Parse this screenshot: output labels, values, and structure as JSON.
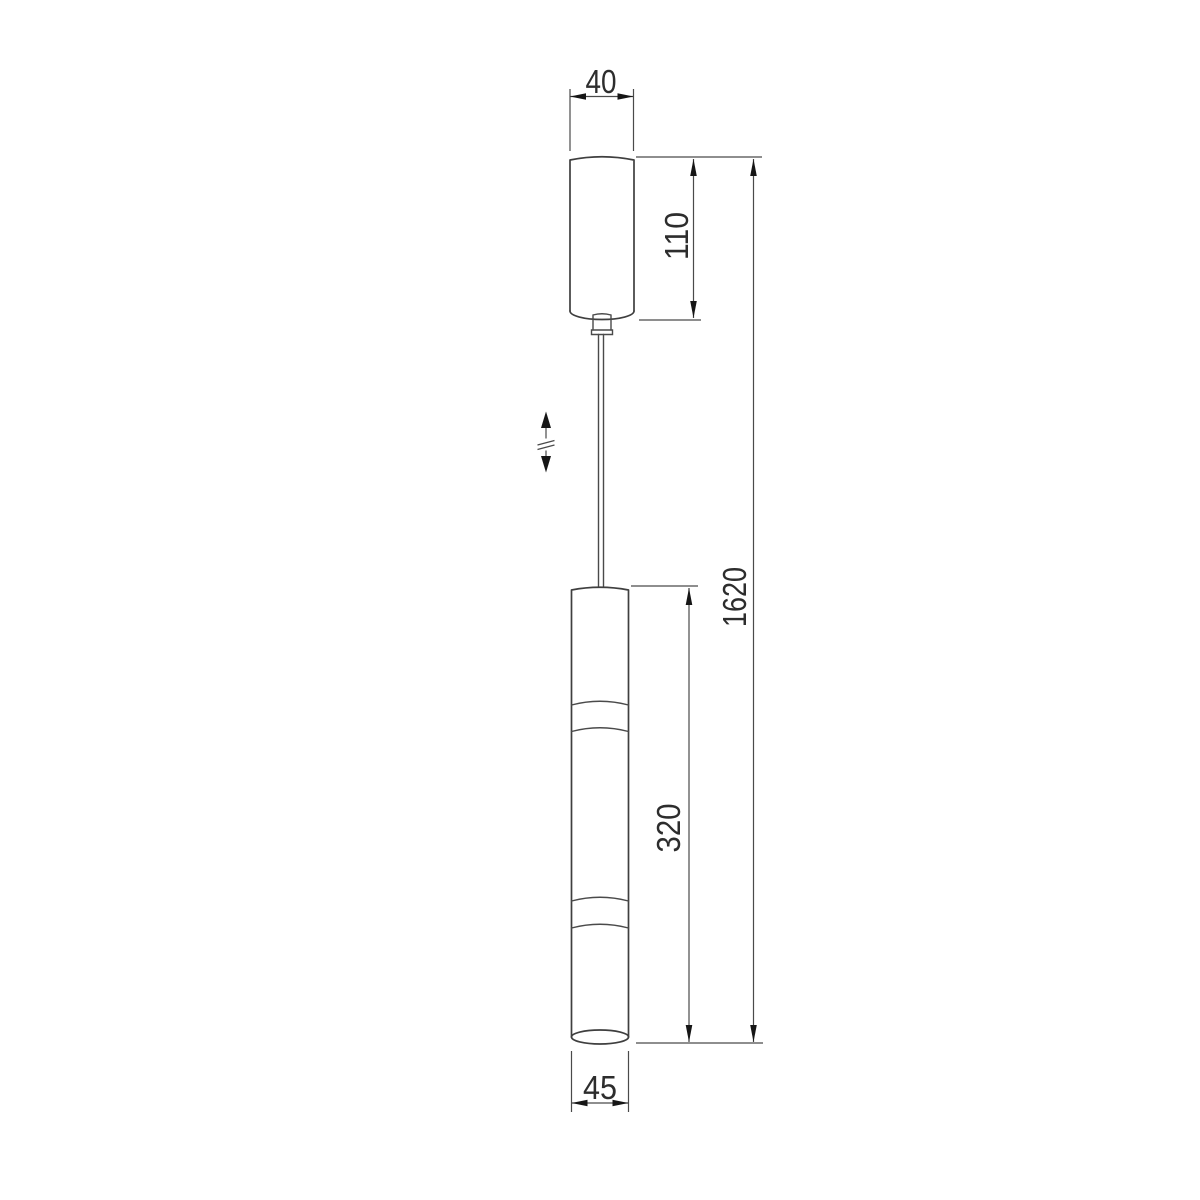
{
  "drawing": {
    "kind": "technical dimension drawing",
    "subject": "pendant lamp with ceiling canopy, adjustable suspension cable and tubular shade",
    "background_color": "#ffffff",
    "object_line_color": "#3f3f3f",
    "dimension_line_color": "#4a4a4a",
    "text_color": "#2d2d2d",
    "dimensions": {
      "canopy_width": "40",
      "canopy_height": "110",
      "overall_height": "1620",
      "body_height": "320",
      "body_width": "45"
    },
    "symbols": {
      "height_adjust": "double-headed arrow with break (adjustable cable length)"
    }
  }
}
